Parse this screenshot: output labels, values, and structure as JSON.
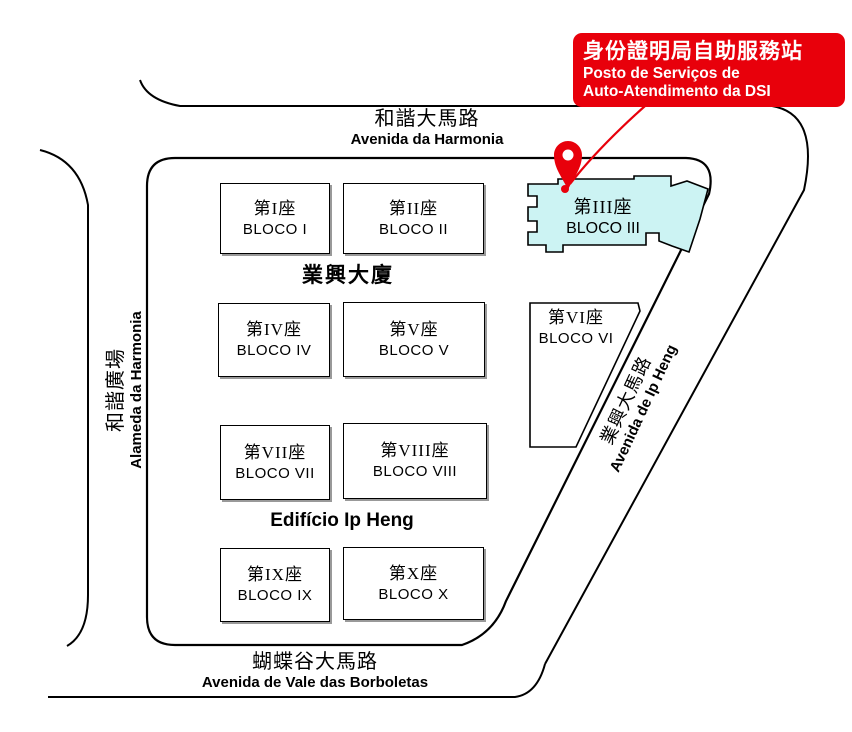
{
  "colors": {
    "accent_red": "#e8000b",
    "highlight_fill": "#ccf3f3",
    "road_line": "#000000",
    "box_shadow": "#999999"
  },
  "callout": {
    "zh": "身份證明局自助服務站",
    "pt_line1": "Posto de Serviços de",
    "pt_line2": "Auto-Atendimento da DSI"
  },
  "streets": {
    "top": {
      "zh": "和諧大馬路",
      "pt": "Avenida da Harmonia"
    },
    "left": {
      "zh": "和諧廣場",
      "pt": "Alameda da Harmonia"
    },
    "diagonal": {
      "zh": "業興大馬路",
      "pt": "Avenida de Ip Heng"
    },
    "bottom": {
      "zh": "蝴蝶谷大馬路",
      "pt": "Avenida de Vale das Borboletas"
    }
  },
  "complex": {
    "zh": "業興大廈",
    "pt": "Edifício Ip Heng"
  },
  "blocks": [
    {
      "zh": "第I座",
      "pt": "BLOCO I"
    },
    {
      "zh": "第II座",
      "pt": "BLOCO II"
    },
    {
      "zh": "第III座",
      "pt": "BLOCO III"
    },
    {
      "zh": "第IV座",
      "pt": "BLOCO IV"
    },
    {
      "zh": "第V座",
      "pt": "BLOCO V"
    },
    {
      "zh": "第VI座",
      "pt": "BLOCO VI"
    },
    {
      "zh": "第VII座",
      "pt": "BLOCO VII"
    },
    {
      "zh": "第VIII座",
      "pt": "BLOCO VIII"
    },
    {
      "zh": "第IX座",
      "pt": "BLOCO IX"
    },
    {
      "zh": "第X座",
      "pt": "BLOCO X"
    }
  ]
}
